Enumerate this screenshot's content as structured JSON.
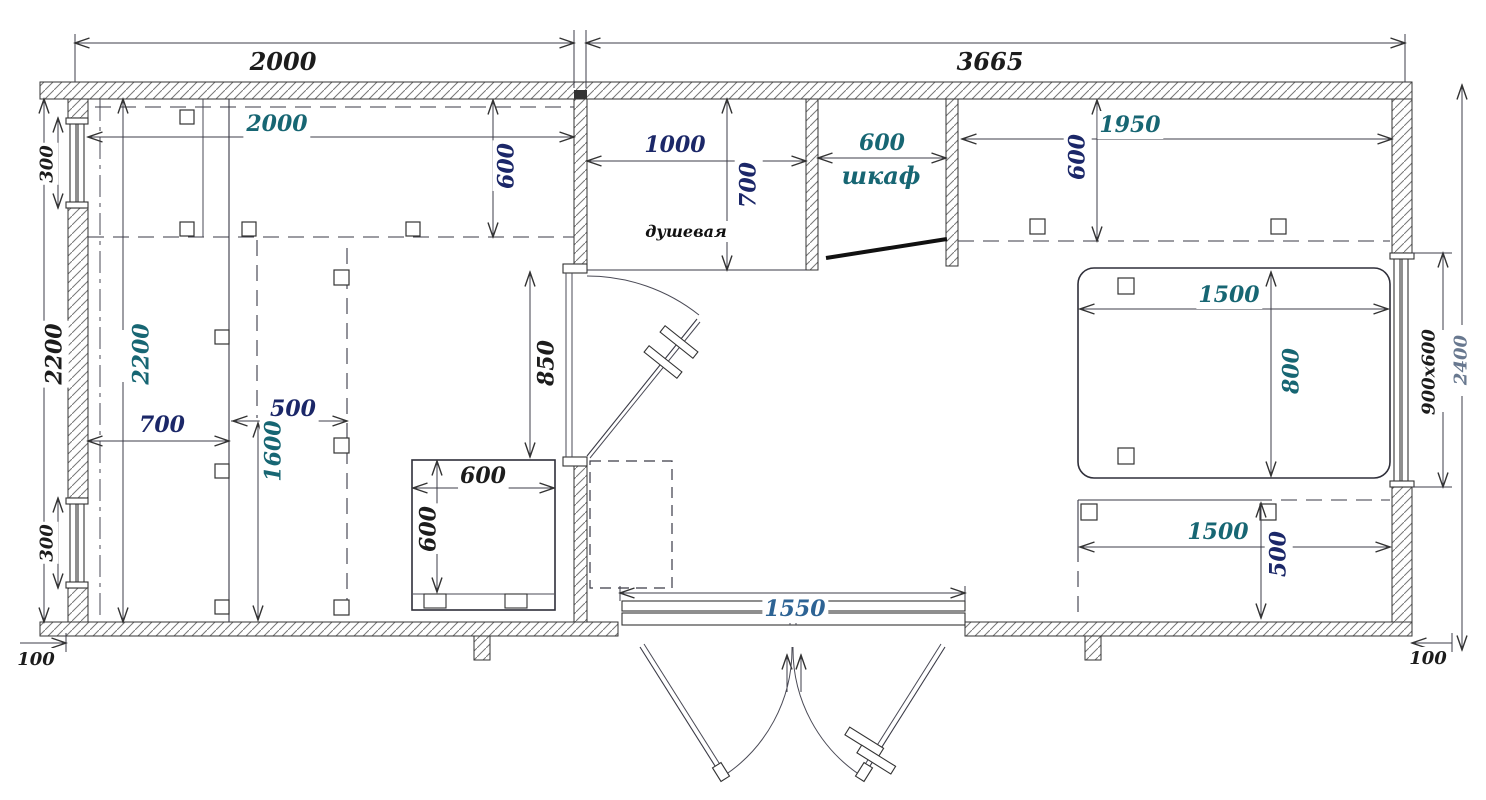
{
  "drawing": {
    "type": "floor-plan",
    "units": "mm",
    "room_names": [
      "душевая",
      "шкаф"
    ]
  },
  "palette": {
    "black": "#1c1c1c",
    "navy": "#1b2768",
    "teal": "#176673",
    "steel": "#2d6394",
    "gray": "#68788f"
  },
  "labels": {
    "top_width_left": {
      "text": "2000",
      "color": "#1c1c1c"
    },
    "top_width_right": {
      "text": "3665",
      "color": "#1c1c1c"
    },
    "window_left_top": {
      "text": "300",
      "color": "#1c1c1c"
    },
    "window_left_bottom": {
      "text": "300",
      "color": "#1c1c1c"
    },
    "height_outer": {
      "text": "2200",
      "color": "#1c1c1c"
    },
    "height_inner": {
      "text": "2200",
      "color": "#176673"
    },
    "shelf_left_width": {
      "text": "2000",
      "color": "#176673"
    },
    "shelf_left_depth": {
      "text": "600",
      "color": "#1b2768"
    },
    "bay_width": {
      "text": "700",
      "color": "#1b2768"
    },
    "cabinet_width": {
      "text": "500",
      "color": "#1b2768"
    },
    "cabinet_depth": {
      "text": "1600",
      "color": "#176673"
    },
    "stove_width": {
      "text": "600",
      "color": "#1c1c1c"
    },
    "stove_depth": {
      "text": "600",
      "color": "#1c1c1c"
    },
    "door_opening": {
      "text": "850",
      "color": "#1c1c1c"
    },
    "shower_width": {
      "text": "1000",
      "color": "#1b2768"
    },
    "shower_depth": {
      "text": "700",
      "color": "#1b2768"
    },
    "shower_name": {
      "text": "душевая",
      "color": "#111111"
    },
    "closet_width": {
      "text": "600",
      "color": "#176673"
    },
    "closet_name": {
      "text": "шкаф",
      "color": "#176673"
    },
    "shelf_right_width": {
      "text": "1950",
      "color": "#176673"
    },
    "shelf_right_depth": {
      "text": "600",
      "color": "#1b2768"
    },
    "bed_length": {
      "text": "1500",
      "color": "#176673"
    },
    "bed_width": {
      "text": "800",
      "color": "#176673"
    },
    "bench_length": {
      "text": "1500",
      "color": "#176673"
    },
    "bench_depth": {
      "text": "500",
      "color": "#1b2768"
    },
    "entry_width": {
      "text": "1550",
      "color": "#2d6394"
    },
    "offset_left": {
      "text": "100",
      "color": "#1c1c1c"
    },
    "offset_right": {
      "text": "100",
      "color": "#1c1c1c"
    },
    "window_right_size": {
      "text": "900x600",
      "color": "#1c1c1c"
    },
    "height_right": {
      "text": "2400",
      "color": "#68788f"
    }
  }
}
